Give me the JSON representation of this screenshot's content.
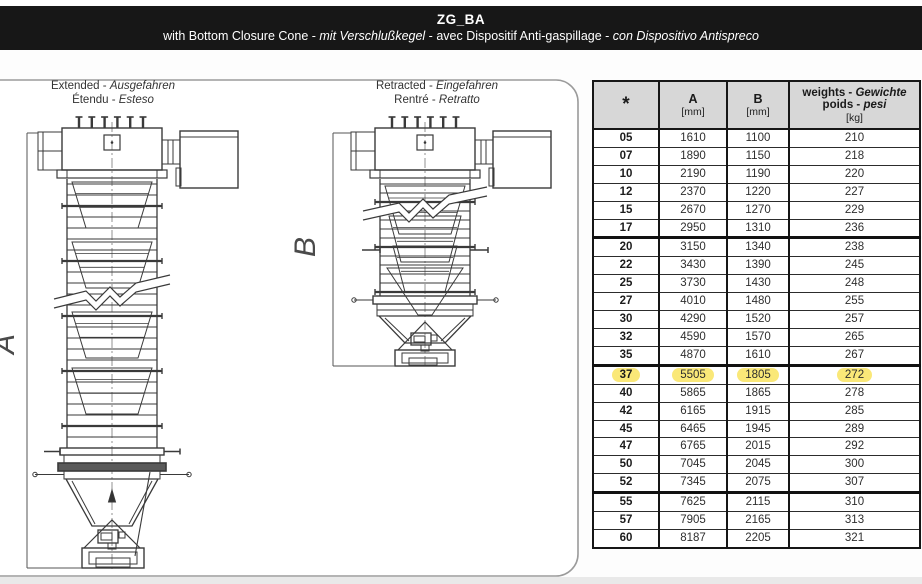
{
  "header": {
    "title": "ZG_BA",
    "subtitle_parts": [
      {
        "t": "with Bottom Closure Cone",
        "i": false
      },
      {
        "t": " - ",
        "i": false
      },
      {
        "t": "mit Verschlußkegel",
        "i": true
      },
      {
        "t": " - ",
        "i": false
      },
      {
        "t": "avec Dispositif Anti-gaspillage",
        "i": false
      },
      {
        "t": " - ",
        "i": false
      },
      {
        "t": "con Dispositivo Antispreco",
        "i": true
      }
    ]
  },
  "drawings": {
    "extended": {
      "label_line1": [
        {
          "t": "Extended",
          "i": false
        },
        {
          "t": " - ",
          "i": false
        },
        {
          "t": "Ausgefahren",
          "i": true
        }
      ],
      "label_line2": [
        {
          "t": "Étendu",
          "i": false
        },
        {
          "t": " - ",
          "i": false
        },
        {
          "t": "Esteso",
          "i": true
        }
      ],
      "dimension_letter": "A"
    },
    "retracted": {
      "label_line1": [
        {
          "t": "Retracted",
          "i": false
        },
        {
          "t": " - ",
          "i": false
        },
        {
          "t": "Eingefahren",
          "i": true
        }
      ],
      "label_line2": [
        {
          "t": "Rentré",
          "i": false
        },
        {
          "t": " - ",
          "i": false
        },
        {
          "t": "Retratto",
          "i": true
        }
      ],
      "dimension_letter": "B"
    }
  },
  "table": {
    "columns": {
      "star": "*",
      "a": {
        "label": "A",
        "unit": "[mm]"
      },
      "b": {
        "label": "B",
        "unit": "[mm]"
      },
      "weights": {
        "line1": [
          {
            "t": "weights - ",
            "i": false
          },
          {
            "t": "Gewichte",
            "i": true
          }
        ],
        "line2": [
          {
            "t": "poids - ",
            "i": false
          },
          {
            "t": "pesi",
            "i": true
          }
        ],
        "unit": "[kg]"
      }
    },
    "rows": [
      {
        "values": [
          "05",
          "1610",
          "1100",
          "210"
        ],
        "group_start": false,
        "highlight": false
      },
      {
        "values": [
          "07",
          "1890",
          "1150",
          "218"
        ],
        "group_start": false,
        "highlight": false
      },
      {
        "values": [
          "10",
          "2190",
          "1190",
          "220"
        ],
        "group_start": false,
        "highlight": false
      },
      {
        "values": [
          "12",
          "2370",
          "1220",
          "227"
        ],
        "group_start": false,
        "highlight": false
      },
      {
        "values": [
          "15",
          "2670",
          "1270",
          "229"
        ],
        "group_start": false,
        "highlight": false
      },
      {
        "values": [
          "17",
          "2950",
          "1310",
          "236"
        ],
        "group_start": false,
        "highlight": false
      },
      {
        "values": [
          "20",
          "3150",
          "1340",
          "238"
        ],
        "group_start": true,
        "highlight": false
      },
      {
        "values": [
          "22",
          "3430",
          "1390",
          "245"
        ],
        "group_start": false,
        "highlight": false
      },
      {
        "values": [
          "25",
          "3730",
          "1430",
          "248"
        ],
        "group_start": false,
        "highlight": false
      },
      {
        "values": [
          "27",
          "4010",
          "1480",
          "255"
        ],
        "group_start": false,
        "highlight": false
      },
      {
        "values": [
          "30",
          "4290",
          "1520",
          "257"
        ],
        "group_start": false,
        "highlight": false
      },
      {
        "values": [
          "32",
          "4590",
          "1570",
          "265"
        ],
        "group_start": false,
        "highlight": false
      },
      {
        "values": [
          "35",
          "4870",
          "1610",
          "267"
        ],
        "group_start": false,
        "highlight": false
      },
      {
        "values": [
          "37",
          "5505",
          "1805",
          "272"
        ],
        "group_start": true,
        "highlight": true
      },
      {
        "values": [
          "40",
          "5865",
          "1865",
          "278"
        ],
        "group_start": false,
        "highlight": false
      },
      {
        "values": [
          "42",
          "6165",
          "1915",
          "285"
        ],
        "group_start": false,
        "highlight": false
      },
      {
        "values": [
          "45",
          "6465",
          "1945",
          "289"
        ],
        "group_start": false,
        "highlight": false
      },
      {
        "values": [
          "47",
          "6765",
          "2015",
          "292"
        ],
        "group_start": false,
        "highlight": false
      },
      {
        "values": [
          "50",
          "7045",
          "2045",
          "300"
        ],
        "group_start": false,
        "highlight": false
      },
      {
        "values": [
          "52",
          "7345",
          "2075",
          "307"
        ],
        "group_start": false,
        "highlight": false
      },
      {
        "values": [
          "55",
          "7625",
          "2115",
          "310"
        ],
        "group_start": true,
        "highlight": false
      },
      {
        "values": [
          "57",
          "7905",
          "2165",
          "313"
        ],
        "group_start": false,
        "highlight": false
      },
      {
        "values": [
          "60",
          "8187",
          "2205",
          "321"
        ],
        "group_start": false,
        "highlight": false
      }
    ]
  },
  "colors": {
    "topbar_bg": "#171717",
    "topbar_text": "#ffffff",
    "table_header_bg": "#d7d7d7",
    "highlight_yellow": "#fae878",
    "drawing_line": "#3a3a3a"
  }
}
